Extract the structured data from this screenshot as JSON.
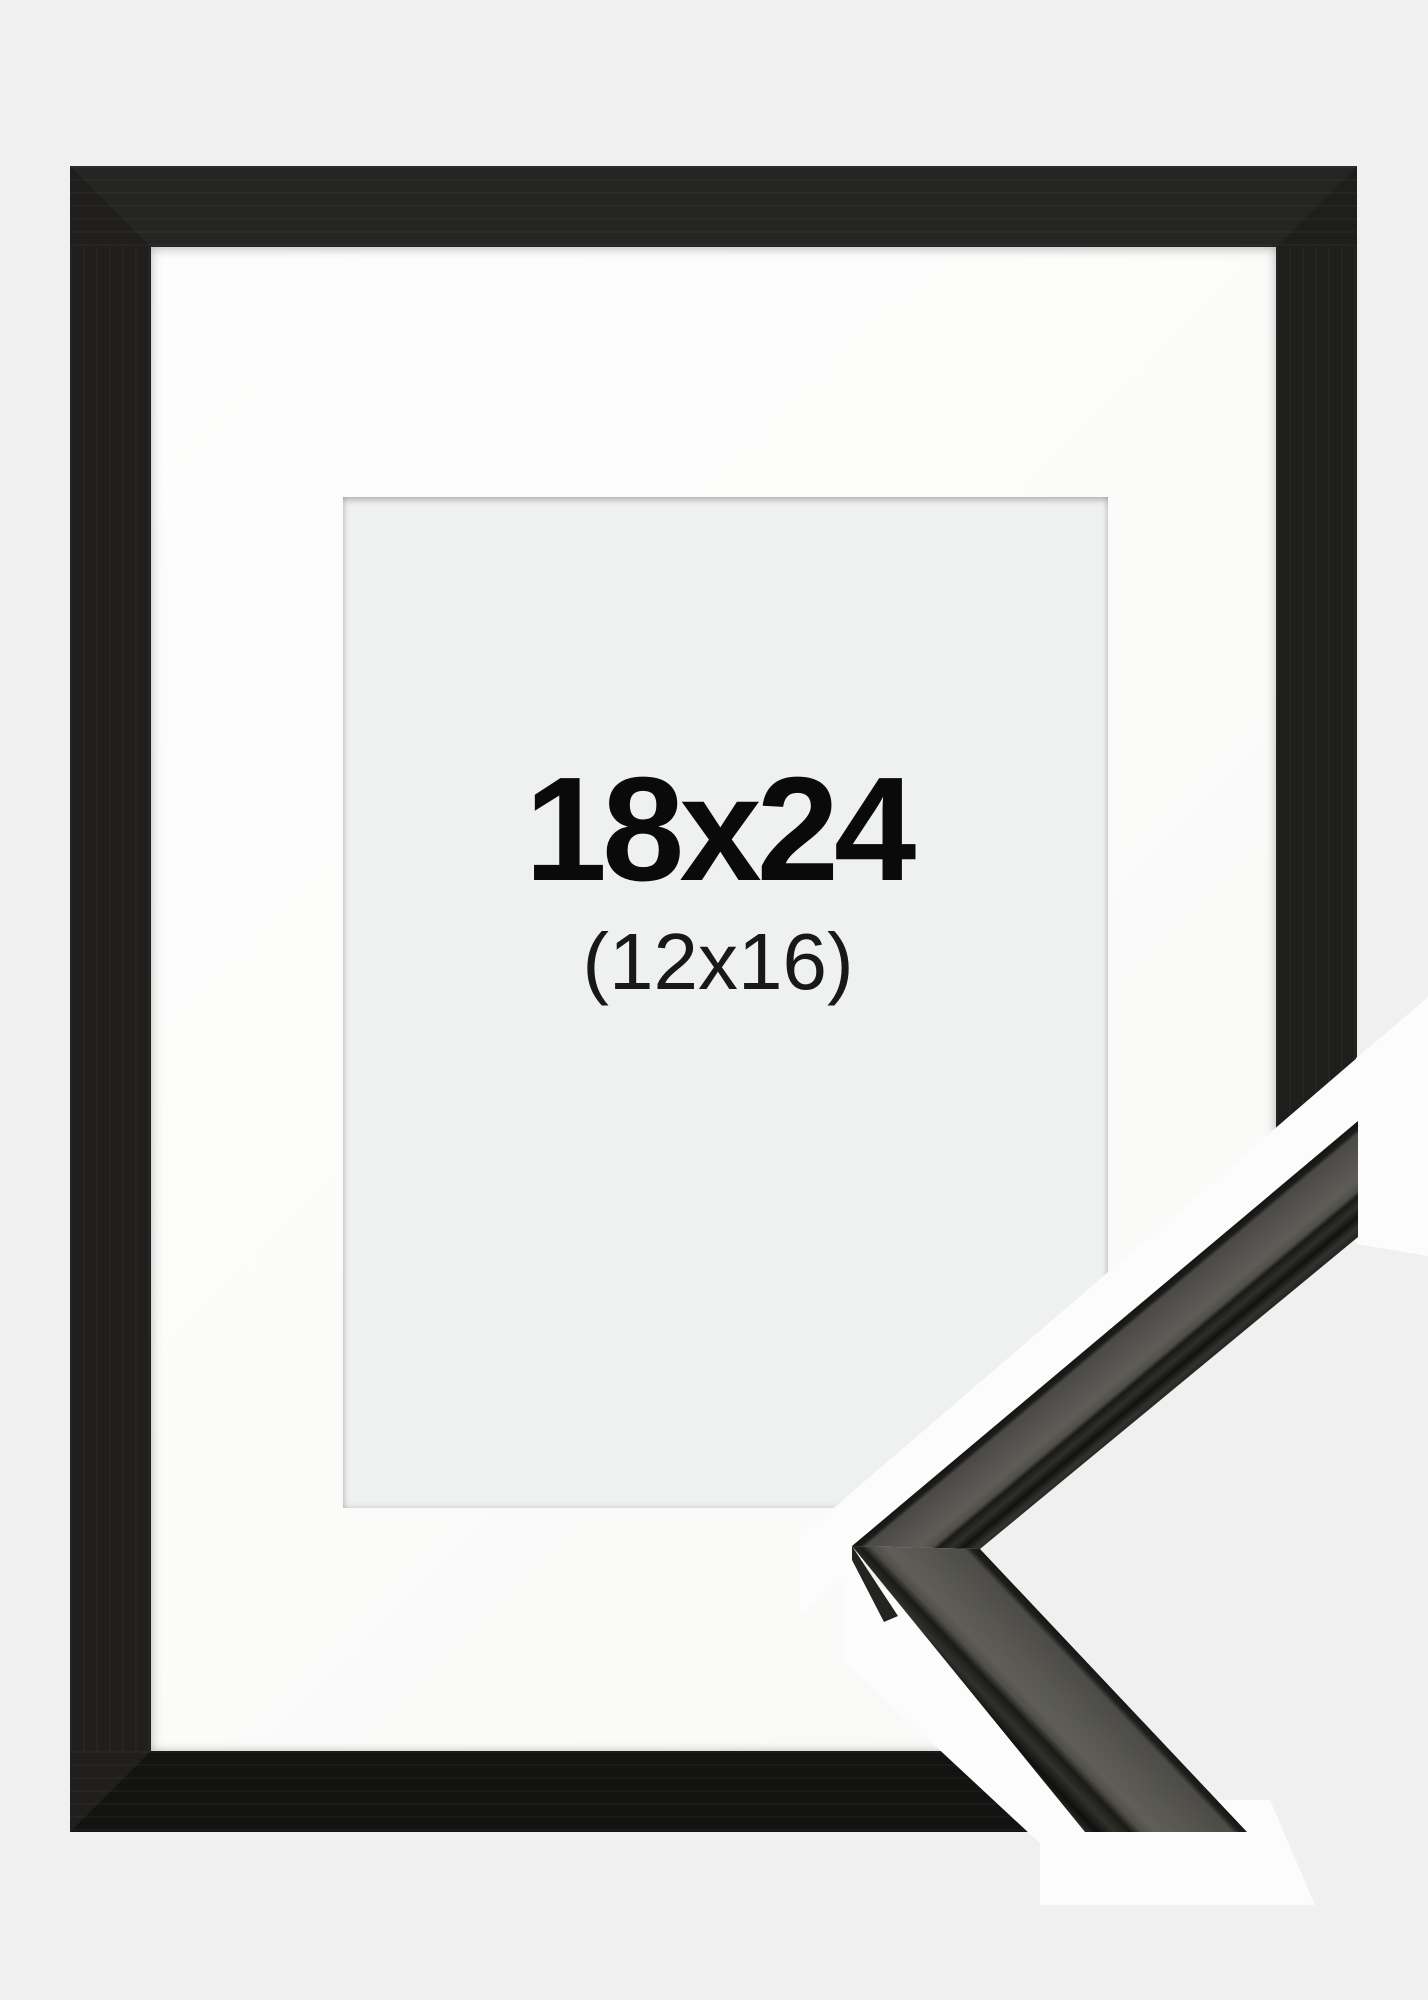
{
  "frame_product": {
    "size_label": "18x24",
    "matted_size_label": "(12x16)"
  },
  "colors": {
    "background": "#f0f0f1",
    "backdrop_white": "#fcfcfc",
    "frame_black": "#1d1d1c",
    "mat_white": "#fbfbfa",
    "window_gray": "#eff0f0",
    "label_text": "#0a0a0a",
    "sample_wood_gray": "#55544f",
    "sample_dark_face": "#23231f"
  }
}
